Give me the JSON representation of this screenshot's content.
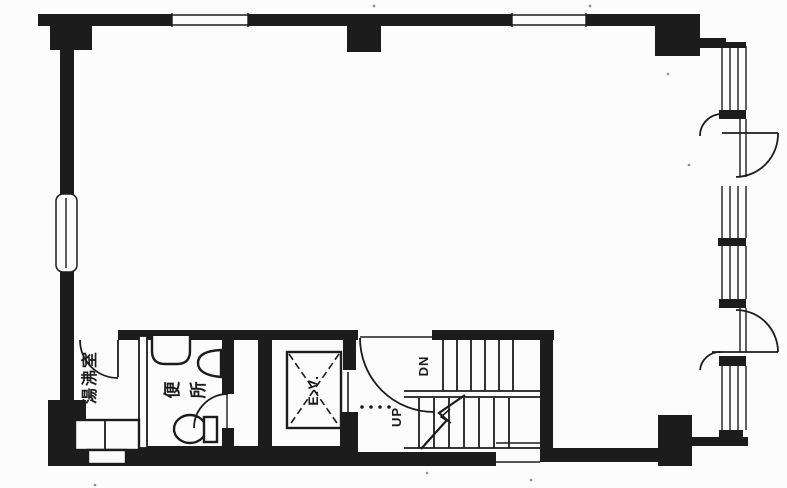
{
  "meta": {
    "title": "Scanned building floor plan"
  },
  "colors": {
    "ink": "#1c1c1c",
    "paper": "#fcfcfc"
  },
  "labels": {
    "elevator": "E.V.",
    "stairs_up": "UP",
    "stairs_down": "DN",
    "toilet_chars": [
      "便",
      "所"
    ],
    "kitchenette": "湯沸室"
  }
}
